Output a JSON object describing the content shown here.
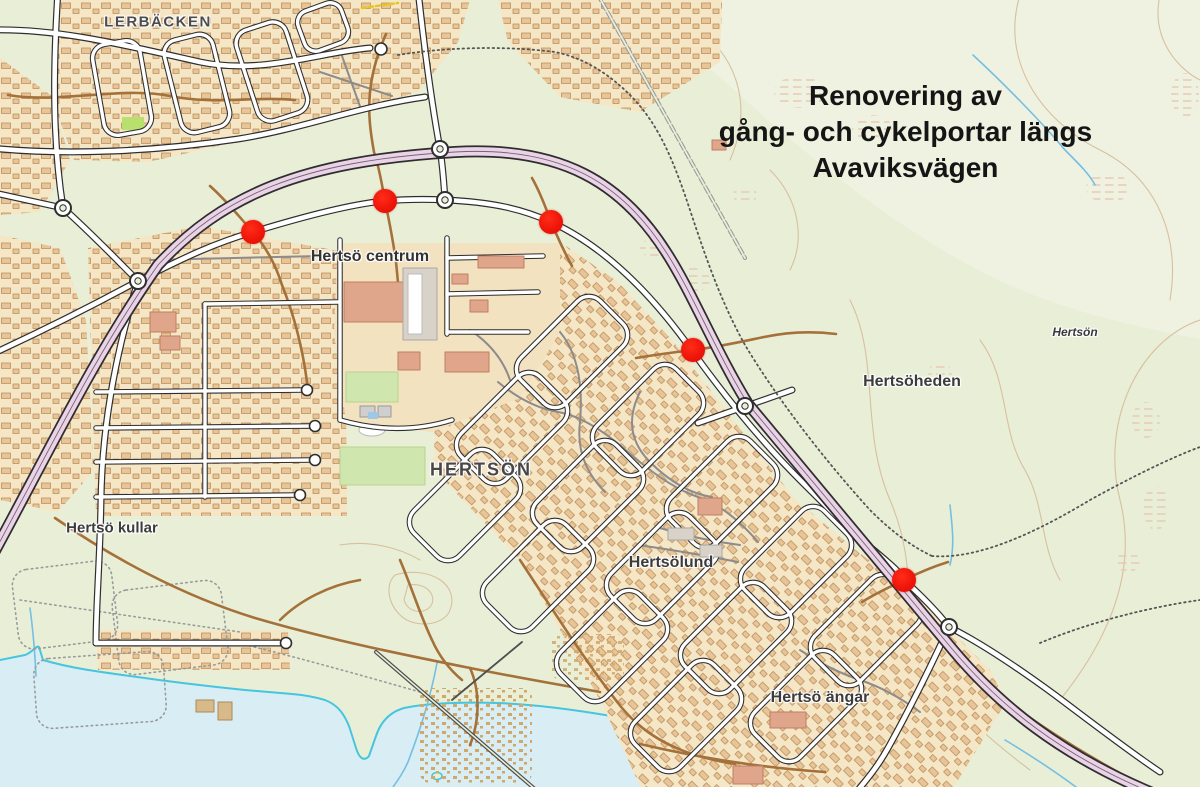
{
  "map": {
    "title": {
      "line1": "Renovering av",
      "line2": "gång- och cykelportar längs",
      "line3": "Avaviksvägen"
    },
    "labels": {
      "lerbacken": "LERBÄCKEN",
      "hertso_centrum": "Hertsö centrum",
      "hertson_small": "Hertsön",
      "hertsoheden": "Hertsöheden",
      "hertson_large": "HERTSÖN",
      "hertso_kullar": "Hertsö kullar",
      "hertsolund": "Hertsölund",
      "hertso_angar": "Hertsö ängar"
    },
    "markers": [
      {
        "name": "renovation-site-1",
        "x": 253,
        "y": 232
      },
      {
        "name": "renovation-site-2",
        "x": 385,
        "y": 201
      },
      {
        "name": "renovation-site-3",
        "x": 551,
        "y": 222
      },
      {
        "name": "renovation-site-4",
        "x": 693,
        "y": 350
      },
      {
        "name": "renovation-site-5",
        "x": 904,
        "y": 580
      }
    ],
    "colors": {
      "marker_red": "#ef150a",
      "highway_pink": "#ecd2e8",
      "water_blue": "#d9edf4",
      "path_brown": "#a5713a",
      "background_green": "#e9efd7"
    }
  }
}
